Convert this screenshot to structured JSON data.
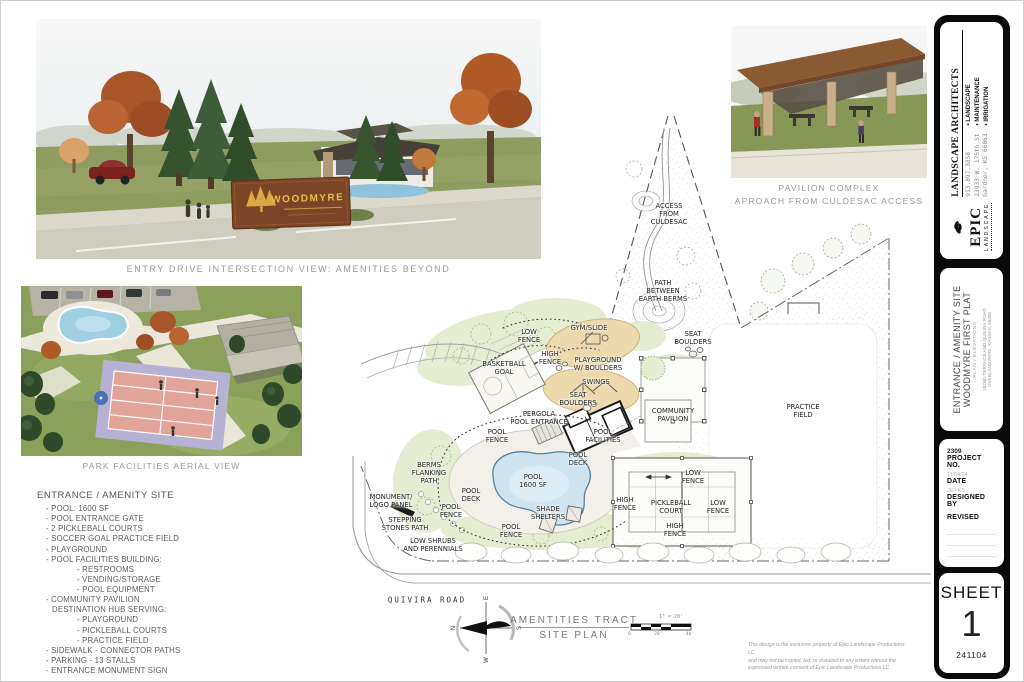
{
  "captions": {
    "entry_view": "ENTRY DRIVE INTERSECTION VIEW: AMENITIES BEYOND",
    "pavilion_line1": "PAVILION COMPLEX",
    "pavilion_line2": "APROACH FROM CULDESAC ACCESS",
    "aerial": "PARK FACILITIES AERIAL VIEW"
  },
  "entry_render": {
    "sign_text": "WOODMYRE"
  },
  "amenity_list": {
    "title": "ENTRANCE / AMENITY SITE",
    "items": [
      {
        "text": "POOL: 1600 SF",
        "indent": 1,
        "dash": true
      },
      {
        "text": "POOL ENTRANCE GATE",
        "indent": 1,
        "dash": true
      },
      {
        "text": "2 PICKLEBALL COURTS",
        "indent": 1,
        "dash": true
      },
      {
        "text": "SOCCER GOAL PRACTICE FIELD",
        "indent": 1,
        "dash": true
      },
      {
        "text": "PLAYGROUND",
        "indent": 1,
        "dash": true
      },
      {
        "text": "POOL FACILITIES BUILDING:",
        "indent": 1,
        "dash": true
      },
      {
        "text": "RESTROOMS",
        "indent": 2,
        "dash": true
      },
      {
        "text": "VENDING/STORAGE",
        "indent": 2,
        "dash": true
      },
      {
        "text": "POOL EQUIPMENT",
        "indent": 2,
        "dash": true
      },
      {
        "text": "COMMUNITY PAVILION",
        "indent": 1,
        "dash": true
      },
      {
        "text": "DESTINATION HUB SERVING:",
        "indent": 1,
        "dash": false
      },
      {
        "text": "PLAYGROUND",
        "indent": 2,
        "dash": true
      },
      {
        "text": "PICKLEBALL COURTS",
        "indent": 2,
        "dash": true
      },
      {
        "text": "PRACTICE FIELD",
        "indent": 2,
        "dash": true
      },
      {
        "text": "SIDEWALK - CONNECTOR PATHS",
        "indent": 1,
        "dash": true
      },
      {
        "text": "PARKING - 13 STALLS",
        "indent": 1,
        "dash": true
      },
      {
        "text": "ENTRANCE MONUMENT SIGN",
        "indent": 1,
        "dash": true
      }
    ]
  },
  "site_plan": {
    "labels": [
      {
        "text": "ACCESS\nFROM\nCULDESAC",
        "x": 328,
        "y": 108
      },
      {
        "text": "PATH\nBETWEEN\nEARTH BERMS",
        "x": 322,
        "y": 185
      },
      {
        "text": "LOW\nFENCE",
        "x": 188,
        "y": 230
      },
      {
        "text": "GYM/SLIDE",
        "x": 248,
        "y": 222
      },
      {
        "text": "PLAYGROUND\nW/ BOULDERS",
        "x": 257,
        "y": 258
      },
      {
        "text": "HIGH\nFENCE",
        "x": 209,
        "y": 252
      },
      {
        "text": "BASKETBALL\nGOAL",
        "x": 163,
        "y": 262
      },
      {
        "text": "SWINGS",
        "x": 255,
        "y": 276
      },
      {
        "text": "SEAT\nBOULDERS",
        "x": 237,
        "y": 293
      },
      {
        "text": "SEAT\nBOULDERS",
        "x": 352,
        "y": 232
      },
      {
        "text": "COMMUNITY\nPAVILION",
        "x": 332,
        "y": 309
      },
      {
        "text": "PRACTICE\nFIELD",
        "x": 462,
        "y": 305
      },
      {
        "text": "PERGOLA\nPOOL ENTRANCE",
        "x": 198,
        "y": 312
      },
      {
        "text": "POOL\nFENCE",
        "x": 156,
        "y": 330
      },
      {
        "text": "POOL\nFACILITIES",
        "x": 262,
        "y": 330
      },
      {
        "text": "BERMS\nFLANKING\nPATH",
        "x": 88,
        "y": 367
      },
      {
        "text": "POOL\nDECK",
        "x": 130,
        "y": 389
      },
      {
        "text": "POOL\n1600 SF",
        "x": 192,
        "y": 375
      },
      {
        "text": "POOL\nDECK",
        "x": 237,
        "y": 353
      },
      {
        "text": "MONUMENT/\nLOGO PANEL",
        "x": 50,
        "y": 395
      },
      {
        "text": "POOL\nFENCE",
        "x": 110,
        "y": 405
      },
      {
        "text": "STEPPING\nSTONES PATH",
        "x": 64,
        "y": 418
      },
      {
        "text": "SHADE\nSHELTERS",
        "x": 207,
        "y": 407
      },
      {
        "text": "POOL\nFENCE",
        "x": 170,
        "y": 425
      },
      {
        "text": "LOW SHRUBS\nAND PERENNIALS",
        "x": 92,
        "y": 439
      },
      {
        "text": "LOW\nFENCE",
        "x": 352,
        "y": 371
      },
      {
        "text": "HIGH\nFENCE",
        "x": 284,
        "y": 398
      },
      {
        "text": "PICKLEBALL\nCOURT",
        "x": 330,
        "y": 401
      },
      {
        "text": "LOW\nFENCE",
        "x": 377,
        "y": 401
      },
      {
        "text": "HIGH\nFENCE",
        "x": 334,
        "y": 424
      }
    ],
    "road_label": "QUIVIRA ROAD",
    "title_line1": "AMENTITIES TRACT",
    "title_line2": "SITE PLAN",
    "scale_text": "1\" = 20'",
    "scale_ticks": [
      "0",
      "20'",
      "40'"
    ],
    "compass": {
      "n": "N",
      "e": "E",
      "s": "S",
      "w": "W"
    }
  },
  "disclaimer": {
    "line1": "This design is the exclusive property of Epic Landscape Productions LC",
    "line2": "and may not be copied, bid, or installed to any extent without the",
    "line3": "expressed written consent of Epic Landscape Productions LC"
  },
  "title_block": {
    "firm": {
      "name": "LANDSCAPE ARCHITECTS",
      "services": [
        "• LANDSCAPE",
        "• MAINTENANCE",
        "• IRRIGATION"
      ],
      "phone": "913.897.3858",
      "address_line1": "23933 W. 175th St",
      "address_line2": "Gardner, KS 66063",
      "logo_name": "EPIC",
      "logo_sub": "LANDSCAPE"
    },
    "project": {
      "line1": "ENTRANCE / AMENITY SITE",
      "line2": "WOODMYRE FIRST PLAT",
      "line3": "PLAN / ELEVATIONS",
      "line4": "182ND TERRACE AND QUIVIRA ROAD",
      "line5": "OVERLAND PARK, KANSAS, 66085"
    },
    "info": {
      "project_no_value": "2309",
      "project_no_label": "PROJECT NO.",
      "date_value": "11/04/24",
      "date_label": "DATE",
      "designed_by_value": "JE / KS",
      "designed_by_label": "DESIGNED BY",
      "revised_label": "REVISED"
    },
    "sheet": {
      "label": "SHEET",
      "number": "1",
      "code": "241104"
    }
  }
}
